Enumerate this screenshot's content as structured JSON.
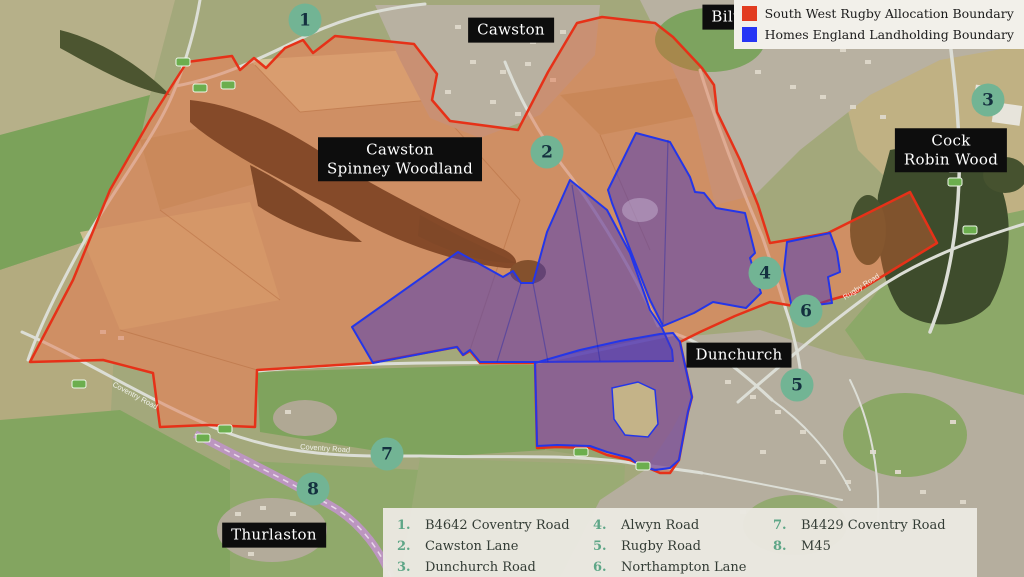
{
  "legend": {
    "items": [
      {
        "label": "South West Rugby Allocation Boundary",
        "color": "#e23c20"
      },
      {
        "label": "Homes England Landholding Boundary",
        "color": "#2635f5"
      }
    ]
  },
  "map": {
    "places": [
      {
        "name": "Cawston",
        "lines": [
          "Cawston"
        ]
      },
      {
        "name": "Bilton",
        "lines": [
          "Bilton"
        ]
      },
      {
        "name": "Cock Robin Wood",
        "lines": [
          "Cock",
          "Robin Wood"
        ]
      },
      {
        "name": "Cawston Spinney Woodland",
        "lines": [
          "Cawston",
          "Spinney Woodland"
        ]
      },
      {
        "name": "Dunchurch",
        "lines": [
          "Dunchurch"
        ]
      },
      {
        "name": "Thurlaston",
        "lines": [
          "Thurlaston"
        ]
      }
    ],
    "street_labels": [
      "Coventry Road",
      "Coventry Road",
      "Rugby Road"
    ],
    "boundary_colors": {
      "allocation": "#e63118",
      "landholding": "#2436e8"
    }
  },
  "markers": [
    {
      "num": "1"
    },
    {
      "num": "2"
    },
    {
      "num": "3"
    },
    {
      "num": "4"
    },
    {
      "num": "5"
    },
    {
      "num": "6"
    },
    {
      "num": "7"
    },
    {
      "num": "8"
    }
  ],
  "key": {
    "items": [
      {
        "num": "1.",
        "label": "B4642 Coventry Road"
      },
      {
        "num": "2.",
        "label": "Cawston Lane"
      },
      {
        "num": "3.",
        "label": "Dunchurch Road"
      },
      {
        "num": "4.",
        "label": "Alwyn Road"
      },
      {
        "num": "5.",
        "label": "Rugby Road"
      },
      {
        "num": "6.",
        "label": "Northampton Lane"
      },
      {
        "num": "7.",
        "label": "B4429 Coventry Road"
      },
      {
        "num": "8.",
        "label": "M45"
      }
    ]
  }
}
